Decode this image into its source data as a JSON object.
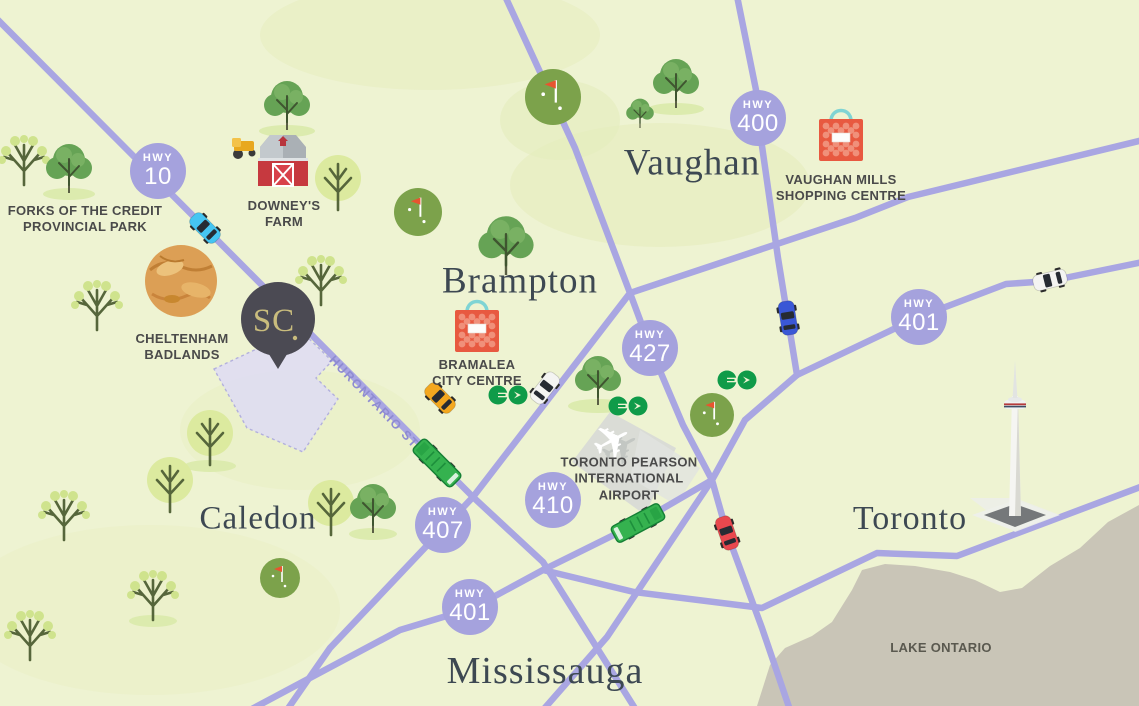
{
  "cities": [
    {
      "name": "Vaughan"
    },
    {
      "name": "Brampton"
    },
    {
      "name": "Caledon"
    },
    {
      "name": "Toronto"
    },
    {
      "name": "Mississauga"
    }
  ],
  "highways": [
    {
      "prefix": "HWY",
      "number": "10"
    },
    {
      "prefix": "HWY",
      "number": "400"
    },
    {
      "prefix": "HWY",
      "number": "427"
    },
    {
      "prefix": "HWY",
      "number": "401"
    },
    {
      "prefix": "HWY",
      "number": "410"
    },
    {
      "prefix": "HWY",
      "number": "407"
    },
    {
      "prefix": "HWY",
      "number": "401"
    }
  ],
  "landmarks": {
    "forks": "FORKS OF THE CREDIT\nPROVINCIAL PARK",
    "downeys": "DOWNEY'S\nFARM",
    "cheltenham": "CHELTENHAM\nBADLANDS",
    "bramalea": "BRAMALEA\nCITY CENTRE",
    "vaughan_mills": "VAUGHAN MILLS\nSHOPPING CENTRE",
    "pearson": "TORONTO PEARSON\nINTERNATIONAL\nAIRPORT",
    "lake": "LAKE ONTARIO",
    "hurontario": "HURONTARIO ST"
  },
  "logo": {
    "text": "SC"
  },
  "icons": {
    "location_pin": "sc-location-pin",
    "transit": "go-transit-logo",
    "shopping": "shopping-bag-icon",
    "farm": "barn-icon",
    "airport": "airplane-icon",
    "tower": "cn-tower-icon",
    "golf": "golf-course-icon",
    "badlands": "badlands-icon"
  },
  "colors": {
    "background": "#eef3d2",
    "road": "#a9a6e2",
    "highway_badge": "#a5a2dd",
    "badge_text": "#ffffff",
    "city_text": "#3d4852",
    "label_text": "#4a4a4a",
    "road_label": "#8e8bd1",
    "lake": "#c9c5b7",
    "site_fill": "#e0def2",
    "pin_background": "#4b4a53",
    "pin_text": "#c9bc7d",
    "go_green": "#0f9b49",
    "bus_green": "#35b24f",
    "bag_red": "#e85940",
    "taxi_yellow": "#f3a71f",
    "golf_green": "#7ca24b",
    "badlands_tan": "#dc9f55"
  }
}
